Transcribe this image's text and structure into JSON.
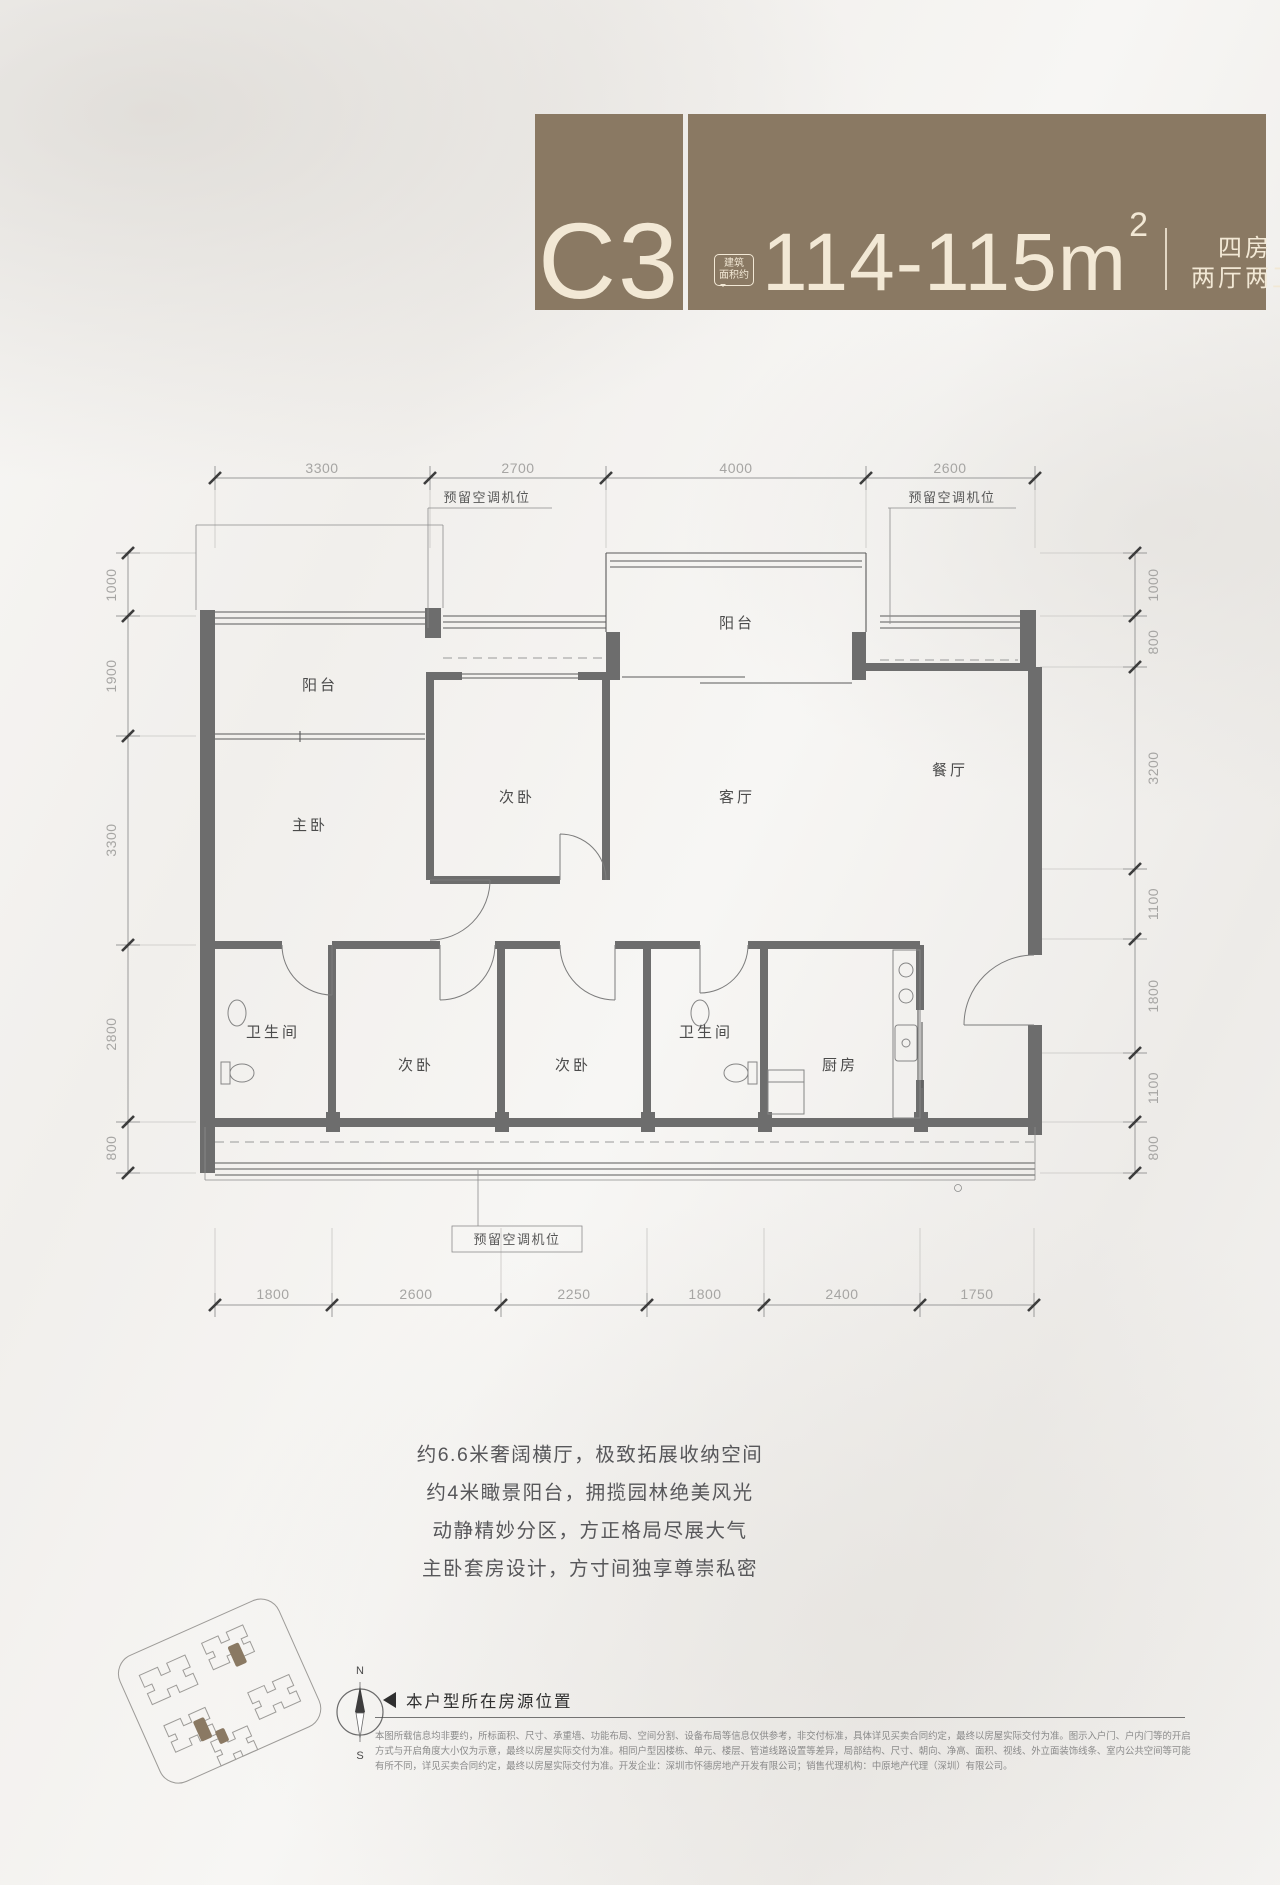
{
  "colors": {
    "brand_brown": "#8a7963",
    "cream": "#f2e8d5"
  },
  "header": {
    "unit_code": "C3",
    "area_badge": [
      "建筑",
      "面积约"
    ],
    "area_value": "114-115m",
    "area_exponent": "2",
    "layout_line1": "四房",
    "layout_line2": "两厅两卫"
  },
  "plan": {
    "rooms": {
      "balcony_left": "阳台",
      "balcony_center": "阳台",
      "bedroom_top": "次卧",
      "living": "客厅",
      "dining": "餐厅",
      "master": "主卧",
      "bath_left": "卫生间",
      "bath_mid": "卫生间",
      "bedroom_bottom_left": "次卧",
      "bedroom_bottom_mid": "次卧",
      "kitchen": "厨房"
    },
    "ac_label_top_left": "预留空调机位",
    "ac_label_top_right": "预留空调机位",
    "ac_label_bottom": "预留空调机位",
    "dims_top": [
      "3300",
      "2700",
      "4000",
      "2600"
    ],
    "dims_bottom": [
      "1800",
      "2600",
      "2250",
      "1800",
      "2400",
      "1750"
    ],
    "dims_left": [
      "1000",
      "1900",
      "3300",
      "2800",
      "800"
    ],
    "dims_right": [
      "1000",
      "800",
      "3200",
      "1100",
      "1800",
      "1100",
      "800"
    ]
  },
  "copy": {
    "lines": [
      "约6.6米奢阔横厅，极致拓展收纳空间",
      "约4米瞰景阳台，拥揽园林绝美风光",
      "动静精妙分区，方正格局尽展大气",
      "主卧套房设计，方寸间独享尊崇私密"
    ]
  },
  "footer": {
    "compass": {
      "north": "N",
      "south": "S"
    },
    "caption": "本户型所在房源位置",
    "disclaimer": [
      "本图所载信息均非要约，所标面积、尺寸、承重墙、功能布局、空间分割、设备布局等信息仅供参考，非交付标准，具体详见买卖合同约定，最终以房屋实际交付为准。图示入户门、户内门等的开启",
      "方式与开启角度大小仅为示意，最终以房屋实际交付为准。相同户型因楼栋、单元、楼层、管道线路设置等差异，局部结构、尺寸、朝向、净高、面积、视线、外立面装饰线条、室内公共空间等可能",
      "有所不同，详见买卖合同约定，最终以房屋实际交付为准。开发企业：深圳市怀德房地产开发有限公司；销售代理机构：中原地产代理（深圳）有限公司。"
    ]
  }
}
